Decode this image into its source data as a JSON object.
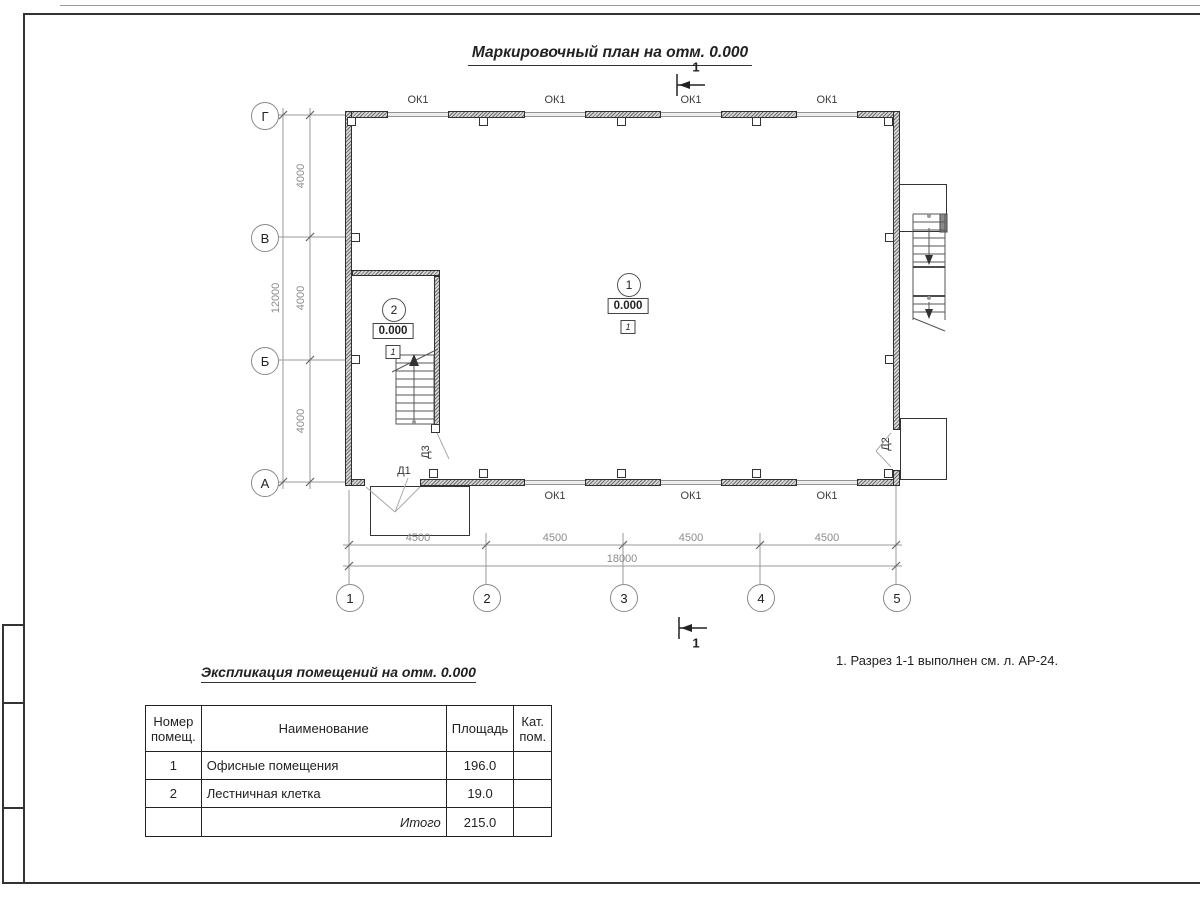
{
  "sheet": {
    "title": "Маркировочный план на отм. 0.000"
  },
  "axes": {
    "rows": [
      {
        "label": "Г"
      },
      {
        "label": "В"
      },
      {
        "label": "Б"
      },
      {
        "label": "А"
      }
    ],
    "cols": [
      {
        "label": "1"
      },
      {
        "label": "2"
      },
      {
        "label": "3"
      },
      {
        "label": "4"
      },
      {
        "label": "5"
      }
    ]
  },
  "dims": {
    "left": [
      "4000",
      "4000",
      "4000"
    ],
    "left_total": "12000",
    "bottom": [
      "4500",
      "4500",
      "4500",
      "4500"
    ],
    "bottom_total": "18000"
  },
  "plan": {
    "window_label": "ОК1",
    "section_label": "1",
    "doors": {
      "d1": "Д1",
      "d2": "Д2",
      "d3": "Д3"
    },
    "rooms": [
      {
        "number": "1",
        "elevation": "0.000",
        "floor_type": "1"
      },
      {
        "number": "2",
        "elevation": "0.000",
        "floor_type": "1"
      }
    ]
  },
  "note": "1. Разрез 1-1 выполнен см. л. АР-24.",
  "table": {
    "title": "Экспликация помещений на отм. 0.000",
    "headers": {
      "num": "Номер помещ.",
      "name": "Наименование",
      "area": "Площадь",
      "cat": "Кат. пом."
    },
    "rows": [
      {
        "num": "1",
        "name": "Офисные помещения",
        "area": "196.0",
        "cat": ""
      },
      {
        "num": "2",
        "name": "Лестничная клетка",
        "area": "19.0",
        "cat": ""
      }
    ],
    "total_label": "Итого",
    "total_area": "215.0"
  },
  "colors": {
    "line": "#333333",
    "dim": "#8c8c8c",
    "wall_hatch": "#6e6e6e"
  }
}
